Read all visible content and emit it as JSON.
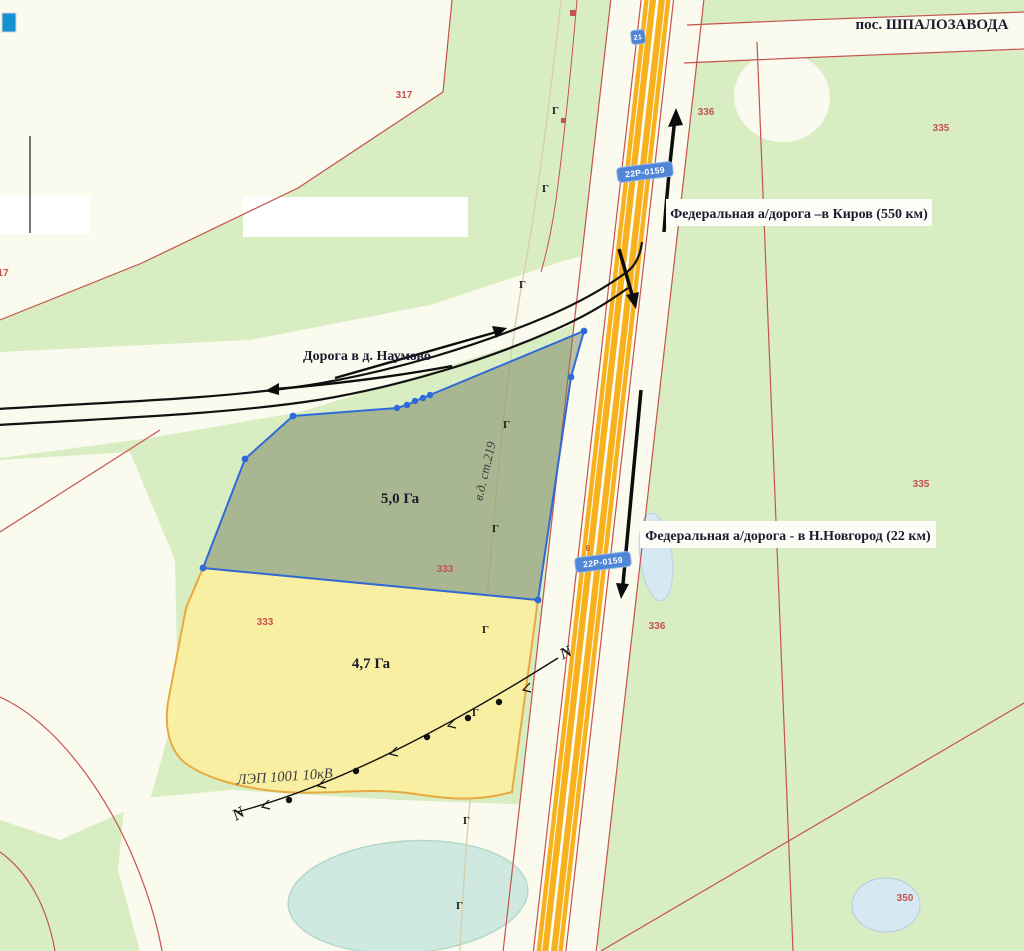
{
  "map": {
    "settlement_label": "пос. ШПАЛОЗАВОДА",
    "kirov_label": "Федеральная а/дорога –в Киров (550 км)",
    "nn_label": "Федеральная а/дорога - в Н.Новгород (22 км)",
    "naumovo_label": "Дорога в д. Наумово",
    "plot1": {
      "area_label": "5,0 Га"
    },
    "plot2": {
      "area_label": "4,7 Га"
    },
    "power_line_label": "ЛЭП 1001 10кВ",
    "railway_label": "в.д. ст.219",
    "road_shield": "22Р-0159",
    "km_marker": "21",
    "gate_marker": "Г",
    "powerline_end_marker": "N",
    "parcel_numbers": [
      {
        "value": "317"
      },
      {
        "value": "317"
      },
      {
        "value": "336"
      },
      {
        "value": "335"
      },
      {
        "value": "335"
      },
      {
        "value": "336"
      },
      {
        "value": "333"
      },
      {
        "value": "333"
      },
      {
        "value": "350"
      },
      {
        "value": "6"
      }
    ],
    "colors": {
      "field_green": "#d9edc2",
      "paper_cream": "#fbfaee",
      "parcel_line_red": "#c4534e",
      "highway_orange": "#f6b11c",
      "plot1_fill_olive": "#77815f",
      "plot1_outline_blue": "#2e6bd8",
      "plot2_yellow": "#fbef9f",
      "plot2_border": "#e9a93e",
      "shield_blue": "#4f86d8",
      "label_ink": "#1b1b2f",
      "pond_aqua": "#cfe9e0",
      "pond_blue": "#d6e9f2",
      "tool_icon_blue": "#1590d2"
    }
  }
}
